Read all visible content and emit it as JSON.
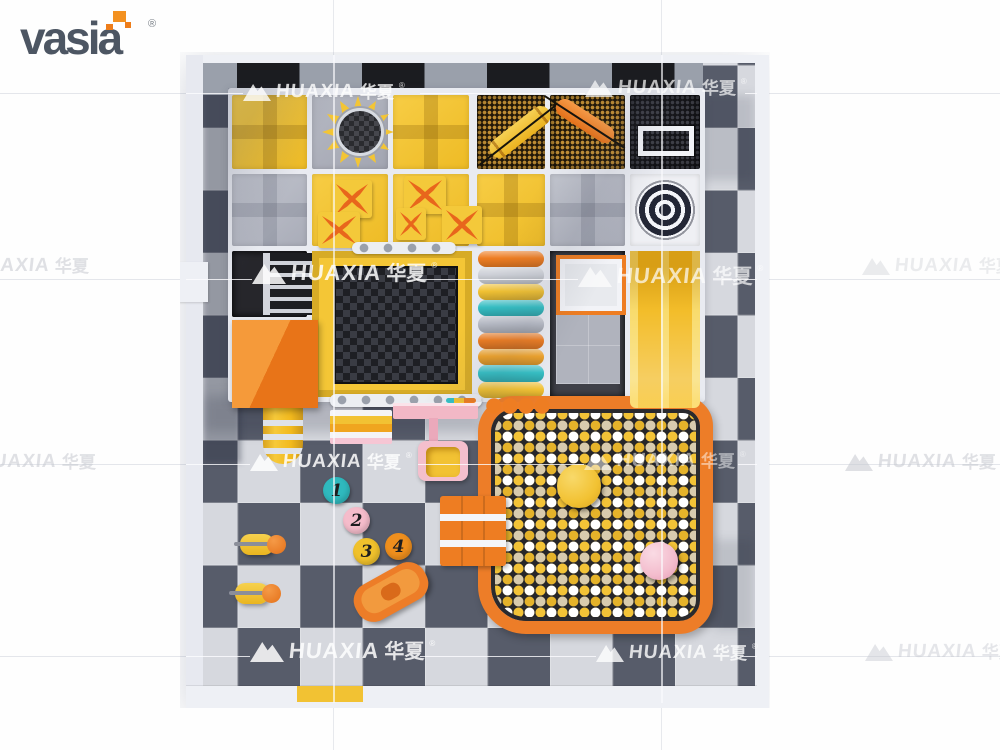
{
  "brand": {
    "name": "vasia",
    "registered": "®"
  },
  "watermark": {
    "latin": "HUAXIA",
    "cjk": "华夏",
    "registered": "®"
  },
  "stepping_stones": [
    {
      "number": "1",
      "color": "#2fb9be"
    },
    {
      "number": "2",
      "color": "#f5bccb"
    },
    {
      "number": "3",
      "color": "#f0c12c"
    },
    {
      "number": "4",
      "color": "#ef8f1d"
    }
  ],
  "palette": {
    "accent_orange": "#ed7d28",
    "play_yellow": "#f2c233",
    "teal": "#35c0c5",
    "pink": "#f6c6d4",
    "floor_dark": "#575c6a",
    "floor_light": "#d6d8de",
    "mesh_black": "#141418",
    "ball_yellow": "#f3c337",
    "ball_white": "#ffffff",
    "ball_tan": "#d8cbae"
  },
  "equipment": [
    "sun-lookout",
    "mesh-climb-panel",
    "bolster-swing",
    "basketball-target",
    "trampoline",
    "roller-steps",
    "double-slide",
    "ball-pit",
    "spiral-slide-exit",
    "platform-box",
    "climb-ladder",
    "ball-pit-steps",
    "kids-table",
    "kids-chair",
    "stepping-stones",
    "ride-on-duck",
    "rocking-toy",
    "entrance-mat"
  ]
}
